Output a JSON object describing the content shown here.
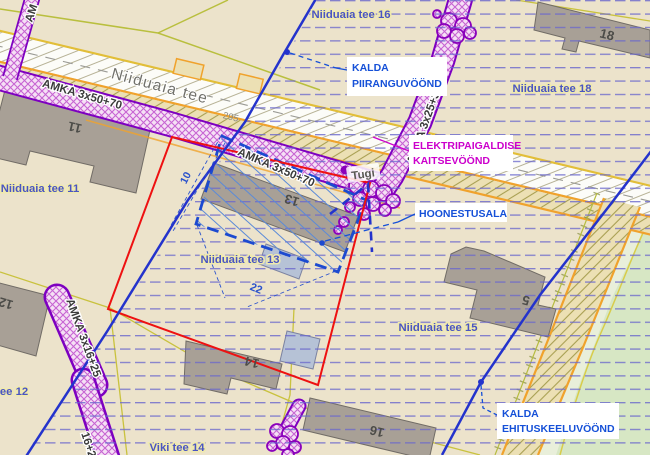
{
  "map": {
    "title": "Detailplaneering — Niiduaia tee (plan view)",
    "street_labels": {
      "main_street": "Niiduaia tee",
      "road_number": "295"
    },
    "parcel_labels": {
      "tee16": "Niiduaia tee 16",
      "tee18": "Niiduaia tee 18",
      "tee11": "Niiduaia tee 11",
      "tee13": "Niiduaia tee 13",
      "tee15": "Niiduaia tee 15",
      "tee12": "ee 12",
      "viki14": "Viki tee 14"
    },
    "house_numbers": {
      "h11": "11",
      "h12": "12",
      "h13": "13",
      "h14": "14",
      "h16": "16",
      "h18": "18",
      "h5": "5"
    },
    "cable_labels": {
      "amka_50_a": "AMKA 3x50+70",
      "amka_50_b": "AMKA 3x50+70",
      "amka_25": "AMKA 3x25+35",
      "amka_16": "AMKA 3x16+25",
      "amka_16_b": "16+25",
      "amka_edge": "AM",
      "support": "Tugi"
    },
    "dimensions": {
      "d10": "10",
      "d22": "22"
    },
    "callouts": {
      "kalda_piirang": {
        "line1": "KALDA",
        "line2": "PIIRANGUVÖÖND",
        "color": "#1550d8"
      },
      "elektri": {
        "line1": "ELEKTRIPAIGALDISE",
        "line2": "KAITSEVÖÖND",
        "color": "#cc00cc"
      },
      "hoonestusala": {
        "line1": "HOONESTUSALA",
        "color": "#1550d8"
      },
      "kalda_ehitus": {
        "line1": "KALDA",
        "line2": "EHITUSKEELUVÖÖND",
        "color": "#1550d8"
      }
    },
    "colors": {
      "background": "#ece3cb",
      "plan_boundary_red": "#ee1111",
      "shore_zone_blue": "#2433cc",
      "hoonestusala_blue": "#1c4ad0",
      "cable_corridor_purple": "#7d00c0",
      "road_yellow": "#e2be38",
      "road_orange": "#f0a22c",
      "cadastral_olive": "#c9c23e",
      "building_grey": "#a8a096",
      "planned_building_blue": "#b6c2d6",
      "greenery": "#d7e7c4",
      "restriction_hatch": "#6a68cc"
    }
  }
}
